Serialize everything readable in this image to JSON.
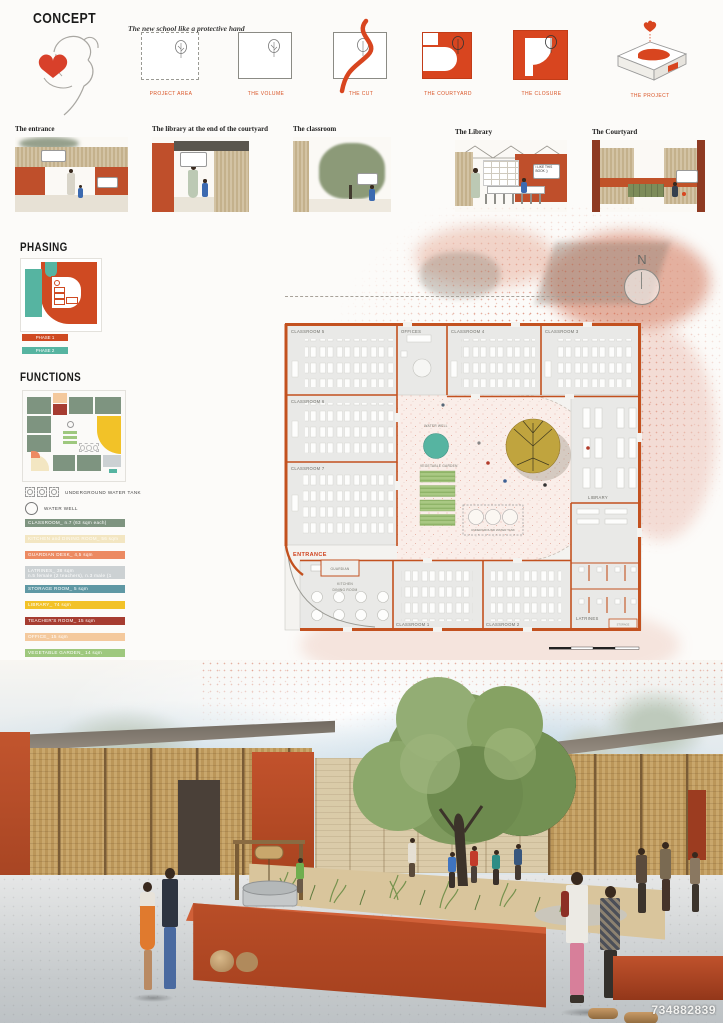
{
  "board": {
    "id_number": "734882839"
  },
  "concept": {
    "title": "CONCEPT",
    "subtitle": "The new school like a protective hand",
    "steps": [
      {
        "label": "PROJECT AREA"
      },
      {
        "label": "THE VOLUME"
      },
      {
        "label": "THE CUT"
      },
      {
        "label": "THE COURTYARD"
      },
      {
        "label": "THE CLOSURE"
      },
      {
        "label": "THE PROJECT"
      }
    ]
  },
  "vignettes": {
    "items": [
      {
        "label": "The entrance"
      },
      {
        "label": "The library at the end of the courtyard"
      },
      {
        "label": "The classroom"
      },
      {
        "label": "The Library",
        "bubble": "I LIKE THIS BOOK ;)"
      },
      {
        "label": "The Courtyard"
      }
    ]
  },
  "phasing": {
    "title": "PHASING",
    "legend": [
      {
        "label": "PHASE 1",
        "color": "#cf4a22"
      },
      {
        "label": "PHASE 2",
        "color": "#56b4a1"
      }
    ]
  },
  "functions": {
    "title": "FUNCTIONS",
    "symbols": [
      {
        "label": "UNDERGROUND WATER TANK"
      },
      {
        "label": "WATER WELL"
      }
    ],
    "legend": [
      {
        "label": "CLASSROOM_ n.7 (63 sqm each)",
        "color": "#7e9480"
      },
      {
        "label": "KITCHEN and DINING ROOM_ 56 sqm",
        "color": "#f3e6c2"
      },
      {
        "label": "GUARDIAN DESK_ 4,5 sqm",
        "color": "#ec8a62"
      },
      {
        "label": "LATRINES_ 38 sqm",
        "label2": "n.5 female (2 teachers), n.3 male (1 teacher)",
        "color": "#ccd1d3"
      },
      {
        "label": "STORAGE ROOM_ 5 sqm",
        "color": "#5f98a4"
      },
      {
        "label": "LIBRARY_ 74 sqm",
        "color": "#f2c228"
      },
      {
        "label": "TEACHER'S ROOM_ 15 sqm",
        "color": "#a63c31"
      },
      {
        "label": "OFFICE_ 15 sqm",
        "color": "#f4c99d"
      },
      {
        "label": "VEGETABLE GARDEN_ 14 sqm",
        "color": "#9ec87e"
      }
    ]
  },
  "plan": {
    "north_label": "N",
    "entrance_label": "ENTRANCE",
    "rooms": {
      "classroom5": "CLASSROOM 5",
      "offices": "OFFICES",
      "classroom4": "CLASSROOM 4",
      "classroom3": "CLASSROOM 3",
      "classroom6": "CLASSROOM 6",
      "classroom7": "CLASSROOM 7",
      "classroom1": "CLASSROOM 1",
      "classroom2": "CLASSROOM 2",
      "guardian": "GUARDIAN",
      "kitchen_line1": "KITCHEN",
      "kitchen_line2": "DINING ROOM",
      "library": "LIBRARY",
      "latrines": "LATRINES",
      "storage": "STORAGE"
    },
    "courtyard": {
      "water_well": "WATER WELL",
      "vegetable_garden": "VEGETABLE GARDEN",
      "water_tank": "UNDERGROUND WATER TANK"
    }
  }
}
